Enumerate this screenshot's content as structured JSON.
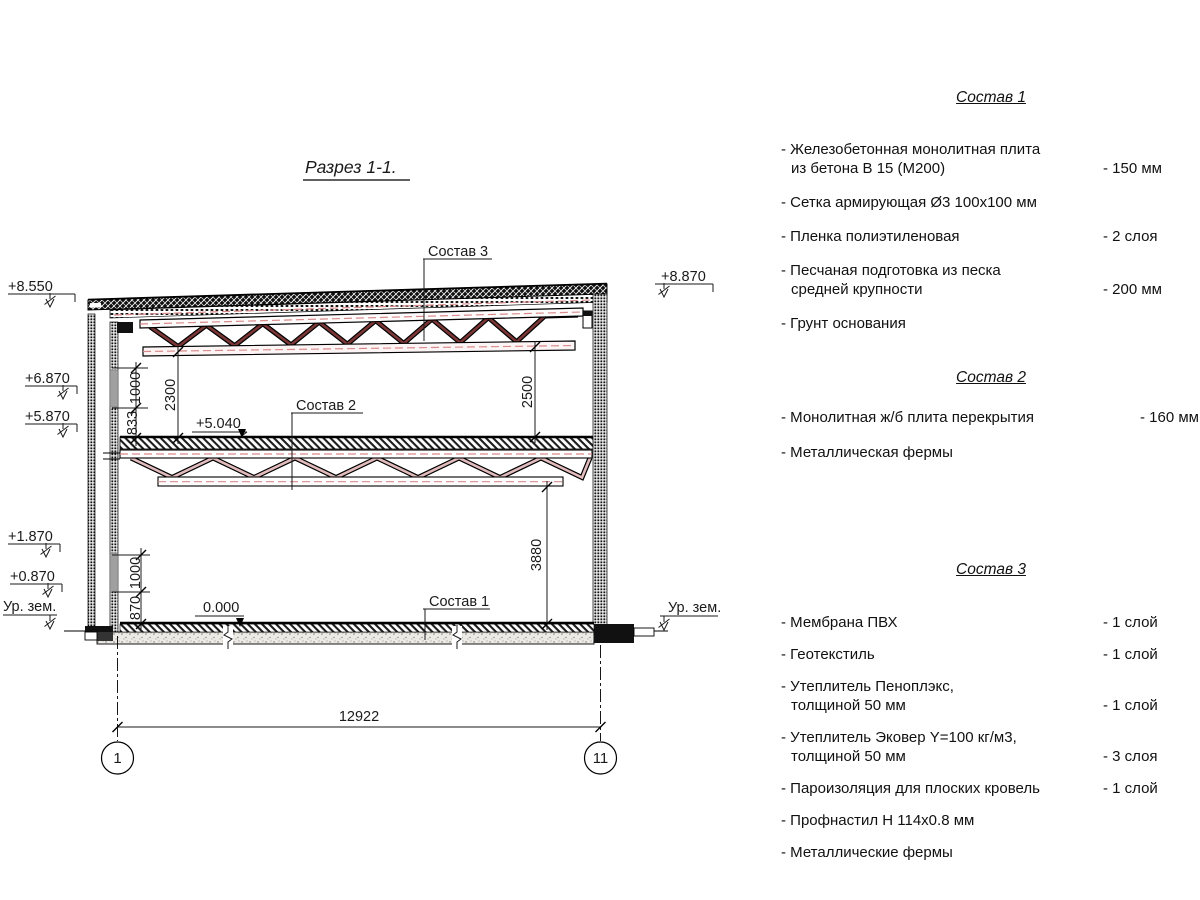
{
  "title": "Разрез 1-1.",
  "drawing": {
    "elevations": {
      "left": [
        "+8.550",
        "+6.870",
        "+5.870",
        "+1.870",
        "+0.870",
        "Ур. зем."
      ],
      "right": [
        "+8.870",
        "Ур. зем."
      ]
    },
    "levels": [
      "+5.040",
      "0.000"
    ],
    "callouts": [
      "Состав 3",
      "Состав 2",
      "Состав 1"
    ],
    "dims": [
      "1000",
      "833",
      "2300",
      "2500",
      "3880",
      "1000",
      "870",
      "12922"
    ],
    "grid": [
      "1",
      "11"
    ],
    "colors": {
      "roof_truss": "#7a3535",
      "floor_truss": "#e2bcbc",
      "axis_dash": "#d98b8b"
    }
  },
  "sections": [
    {
      "heading": "Состав 1",
      "items": [
        {
          "lines": [
            "- Железобетонная  монолитная плита",
            "из бетона В 15 (М200)"
          ],
          "value": "- 150 мм"
        },
        {
          "lines": [
            "- Сетка армирующая Ø3 100х100 мм"
          ],
          "value": ""
        },
        {
          "lines": [
            "- Пленка полиэтиленовая"
          ],
          "value": "-  2 слоя"
        },
        {
          "lines": [
            "- Песчаная подготовка из песка",
            "средней крупности"
          ],
          "value": "- 200 мм"
        },
        {
          "lines": [
            "- Грунт основания"
          ],
          "value": ""
        }
      ]
    },
    {
      "heading": "Состав 2",
      "items": [
        {
          "lines": [
            "- Монолитная ж/б плита перекрытия"
          ],
          "value": "- 160 мм"
        },
        {
          "lines": [
            "- Металлическая фермы"
          ],
          "value": ""
        }
      ]
    },
    {
      "heading": "Состав 3",
      "items": [
        {
          "lines": [
            "- Мембрана ПВХ"
          ],
          "value": "- 1 слой"
        },
        {
          "lines": [
            "- Геотекстиль"
          ],
          "value": "- 1 слой"
        },
        {
          "lines": [
            "- Утеплитель Пеноплэкс,",
            "толщиной 50 мм"
          ],
          "value": "- 1 слой"
        },
        {
          "lines": [
            "- Утеплитель Эковер Y=100 кг/м3,",
            "толщиной 50 мм"
          ],
          "value": "- 3 слоя"
        },
        {
          "lines": [
            "- Пароизоляция для плоских кровель"
          ],
          "value": "- 1 слой"
        },
        {
          "lines": [
            "- Профнастил Н 114х0.8 мм"
          ],
          "value": ""
        },
        {
          "lines": [
            "- Металлические фермы"
          ],
          "value": ""
        }
      ]
    }
  ]
}
